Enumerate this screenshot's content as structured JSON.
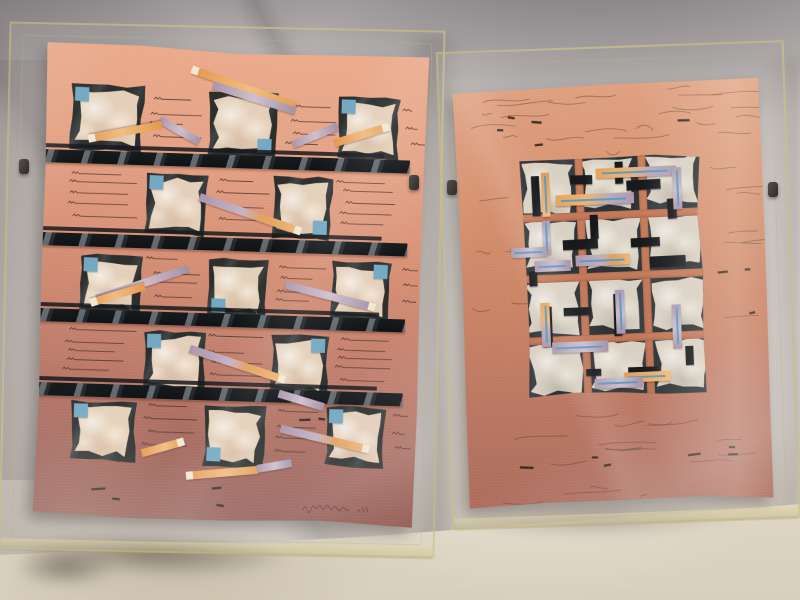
{
  "palette": {
    "fabric": "#d2ccc8",
    "fabric_shadow": "#75737a",
    "floor": "#ddd5c3",
    "paper_left_top": "#ecab8c",
    "paper_left_bottom": "#8f5a53",
    "paper_right_top": "#e0a181",
    "paper_right_bottom": "#ac6c5c",
    "charcoal": "#2e3336",
    "tissue": "#e4d0ba",
    "tissue_right": "#d9d1c3",
    "blue_square": "#74a9c3",
    "blue_line": "#5d9dc2",
    "orange": "#e8a55c",
    "lavender": "#b3a0b5",
    "strip_tip": "#f3e9d3",
    "bar_black": "#14171a",
    "acrylic_edge": "#cbbf81",
    "signature_ink": "#6e352f"
  },
  "frames": {
    "left": {
      "x": 4,
      "y": 26,
      "w": 436,
      "h": 528,
      "rot": 1.2
    },
    "right": {
      "x": 444,
      "y": 46,
      "w": 348,
      "h": 478,
      "rot": -2.0
    },
    "clips": [
      {
        "x": 19,
        "y": 159
      },
      {
        "x": 409,
        "y": 175
      },
      {
        "x": 447,
        "y": 180
      },
      {
        "x": 768,
        "y": 182
      }
    ]
  },
  "floor_shadows": {
    "left": {
      "x": 22,
      "y": 536,
      "w": 350,
      "h": 52,
      "rot": 2
    },
    "right": {
      "x": 444,
      "y": 500,
      "w": 350,
      "h": 44,
      "rot": -1.5
    }
  },
  "left_artwork": {
    "paper": {
      "x": 40,
      "y": 48,
      "w": 382,
      "h": 474,
      "rot": 1.8
    },
    "bar_h": 13,
    "bars": [
      {
        "y": 107
      },
      {
        "y": 190
      },
      {
        "y": 266
      },
      {
        "y": 340
      }
    ],
    "squares": [
      {
        "x": 25,
        "y": 40,
        "w": 74,
        "h": 68,
        "b": "tl"
      },
      {
        "x": 163,
        "y": 42,
        "w": 70,
        "h": 68,
        "b": "br"
      },
      {
        "x": 293,
        "y": 44,
        "w": 62,
        "h": 64,
        "b": "tl"
      },
      {
        "x": 103,
        "y": 126,
        "w": 62,
        "h": 64,
        "b": "tl"
      },
      {
        "x": 230,
        "y": 126,
        "w": 60,
        "h": 64,
        "b": "br"
      },
      {
        "x": 40,
        "y": 210,
        "w": 62,
        "h": 60,
        "b": "tl"
      },
      {
        "x": 168,
        "y": 210,
        "w": 60,
        "h": 60,
        "b": "bl"
      },
      {
        "x": 291,
        "y": 208,
        "w": 60,
        "h": 62,
        "b": "tr"
      },
      {
        "x": 106,
        "y": 284,
        "w": 62,
        "h": 62,
        "b": "tl"
      },
      {
        "x": 233,
        "y": 284,
        "w": 58,
        "h": 62,
        "b": "tr"
      },
      {
        "x": 35,
        "y": 356,
        "w": 66,
        "h": 62,
        "b": "tl"
      },
      {
        "x": 168,
        "y": 356,
        "w": 62,
        "h": 64,
        "b": "bl"
      },
      {
        "x": 290,
        "y": 354,
        "w": 60,
        "h": 62,
        "b": "tl"
      }
    ],
    "strips": [
      {
        "x1": 146,
        "y1": 23,
        "x2": 250,
        "y2": 56,
        "t": "o",
        "tip": "p1"
      },
      {
        "x1": 167,
        "y1": 38,
        "x2": 250,
        "y2": 61,
        "t": "l",
        "tip": ""
      },
      {
        "x1": 115,
        "y1": 74,
        "x2": 155,
        "y2": 95,
        "t": "l",
        "tip": ""
      },
      {
        "x1": 117,
        "y1": 79,
        "x2": 45,
        "y2": 95,
        "t": "o",
        "tip": "p2"
      },
      {
        "x1": 157,
        "y1": 150,
        "x2": 258,
        "y2": 181,
        "t": "lo",
        "tip": "p2"
      },
      {
        "x1": 248,
        "y1": 95,
        "x2": 293,
        "y2": 75,
        "t": "l",
        "tip": ""
      },
      {
        "x1": 290,
        "y1": 92,
        "x2": 343,
        "y2": 74,
        "t": "o",
        "tip": "p2"
      },
      {
        "x1": 57,
        "y1": 255,
        "x2": 147,
        "y2": 222,
        "t": "l",
        "tip": ""
      },
      {
        "x1": 105,
        "y1": 241,
        "x2": 52,
        "y2": 259,
        "t": "o",
        "tip": "p2"
      },
      {
        "x1": 152,
        "y1": 302,
        "x2": 247,
        "y2": 330,
        "t": "lo",
        "tip": "p2"
      },
      {
        "x1": 245,
        "y1": 235,
        "x2": 335,
        "y2": 255,
        "t": "l",
        "tip": "p2"
      },
      {
        "x1": 245,
        "y1": 379,
        "x2": 333,
        "y2": 397,
        "t": "lo",
        "tip": "p2"
      },
      {
        "x1": 107,
        "y1": 408,
        "x2": 148,
        "y2": 395,
        "t": "o",
        "tip": "p2"
      },
      {
        "x1": 153,
        "y1": 429,
        "x2": 223,
        "y2": 421,
        "t": "o",
        "tip": "p1"
      },
      {
        "x1": 223,
        "y1": 420,
        "x2": 257,
        "y2": 413,
        "t": "l",
        "tip": ""
      },
      {
        "x1": 242,
        "y1": 344,
        "x2": 287,
        "y2": 356,
        "t": "l",
        "tip": ""
      }
    ],
    "scribbles": [
      {
        "x": 103,
        "y": 50,
        "w": 54,
        "h": 50,
        "n": 4,
        "t": "line"
      },
      {
        "x": 239,
        "y": 54,
        "w": 46,
        "h": 50,
        "n": 4,
        "t": "line"
      },
      {
        "x": 357,
        "y": 52,
        "w": 16,
        "h": 50,
        "n": 3,
        "t": "line"
      },
      {
        "x": 25,
        "y": 126,
        "w": 70,
        "h": 52,
        "n": 5,
        "t": "line"
      },
      {
        "x": 167,
        "y": 128,
        "w": 56,
        "h": 50,
        "n": 4,
        "t": "line"
      },
      {
        "x": 293,
        "y": 126,
        "w": 62,
        "h": 52,
        "n": 5,
        "t": "line"
      },
      {
        "x": 105,
        "y": 210,
        "w": 56,
        "h": 48,
        "n": 4,
        "t": "line"
      },
      {
        "x": 232,
        "y": 212,
        "w": 52,
        "h": 48,
        "n": 4,
        "t": "line"
      },
      {
        "x": 353,
        "y": 210,
        "w": 18,
        "h": 48,
        "n": 3,
        "t": "line"
      },
      {
        "x": 25,
        "y": 284,
        "w": 74,
        "h": 50,
        "n": 5,
        "t": "line"
      },
      {
        "x": 169,
        "y": 286,
        "w": 58,
        "h": 50,
        "n": 4,
        "t": "line"
      },
      {
        "x": 295,
        "y": 284,
        "w": 60,
        "h": 50,
        "n": 5,
        "t": "line"
      },
      {
        "x": 103,
        "y": 356,
        "w": 58,
        "h": 52,
        "n": 4,
        "t": "line"
      },
      {
        "x": 233,
        "y": 358,
        "w": 50,
        "h": 52,
        "n": 4,
        "t": "line"
      },
      {
        "x": 353,
        "y": 356,
        "w": 18,
        "h": 52,
        "n": 3,
        "t": "line"
      },
      {
        "x": 19,
        "y": 110,
        "w": 30,
        "h": 8,
        "n": 2,
        "t": "dash"
      },
      {
        "x": 19,
        "y": 194,
        "w": 28,
        "h": 8,
        "n": 2,
        "t": "dash"
      },
      {
        "x": 19,
        "y": 270,
        "w": 26,
        "h": 8,
        "n": 2,
        "t": "dash"
      },
      {
        "x": 19,
        "y": 344,
        "w": 28,
        "h": 8,
        "n": 2,
        "t": "dash"
      },
      {
        "x": 47,
        "y": 434,
        "w": 190,
        "h": 26,
        "n": 4,
        "t": "dash"
      },
      {
        "x": 257,
        "y": 360,
        "w": 60,
        "h": 10,
        "n": 2,
        "t": "dash"
      }
    ],
    "signature": {
      "x": 268,
      "y": 450,
      "w": 70,
      "h": 16
    }
  },
  "right_artwork": {
    "paper": {
      "x": 461,
      "y": 84,
      "w": 306,
      "h": 420,
      "rot": -2.4
    },
    "motif": {
      "x": 64,
      "y": 72,
      "w": 180,
      "h": 240,
      "cols": [
        0,
        63,
        126
      ],
      "rows": [
        0,
        61,
        122,
        184
      ],
      "cell_w": 53,
      "cell_h": 53,
      "groove_x": [
        55,
        118
      ],
      "groove_y": [
        55,
        116,
        178
      ],
      "groove_t": 8
    },
    "black_bars": [
      {
        "x": 11,
        "y": 17,
        "w": 8,
        "h": 40
      },
      {
        "x": 50,
        "y": 18,
        "w": 22,
        "h": 9
      },
      {
        "x": 95,
        "y": 6,
        "w": 8,
        "h": 22
      },
      {
        "x": 106,
        "y": 25,
        "w": 34,
        "h": 10
      },
      {
        "x": 146,
        "y": 45,
        "w": 9,
        "h": 20
      },
      {
        "x": 40,
        "y": 82,
        "w": 35,
        "h": 10
      },
      {
        "x": 108,
        "y": 83,
        "w": 29,
        "h": 9
      },
      {
        "x": 126,
        "y": 102,
        "w": 36,
        "h": 11
      },
      {
        "x": 5,
        "y": 112,
        "w": 8,
        "h": 15
      },
      {
        "x": 68,
        "y": 58,
        "w": 8,
        "h": 24
      },
      {
        "x": 16,
        "y": 148,
        "w": 10,
        "h": 40
      },
      {
        "x": 38,
        "y": 150,
        "w": 27,
        "h": 8
      },
      {
        "x": 88,
        "y": 138,
        "w": 8,
        "h": 42
      },
      {
        "x": 58,
        "y": 212,
        "w": 15,
        "h": 7
      },
      {
        "x": 158,
        "y": 193,
        "w": 8,
        "h": 19
      },
      {
        "x": 100,
        "y": 212,
        "w": 30,
        "h": 10
      }
    ],
    "strips": [
      {
        "x": 76,
        "y": 12,
        "w": 80,
        "h": 10,
        "t": "ol",
        "d": "h"
      },
      {
        "x": 152,
        "y": 14,
        "w": 9,
        "h": 42,
        "t": "l",
        "d": "v"
      },
      {
        "x": 21,
        "y": 14,
        "w": 8,
        "h": 44,
        "t": "o",
        "d": "v"
      },
      {
        "x": 35,
        "y": 37,
        "w": 78,
        "h": 11,
        "t": "ol",
        "d": "h"
      },
      {
        "x": 20,
        "y": 62,
        "w": 8,
        "h": 34,
        "t": "l",
        "d": "v"
      },
      {
        "x": 11,
        "y": 102,
        "w": 36,
        "h": 11,
        "t": "l",
        "d": "h"
      },
      {
        "x": 52,
        "y": 98,
        "w": 54,
        "h": 11,
        "t": "lo",
        "d": "h"
      },
      {
        "x": 90,
        "y": 134,
        "w": 9,
        "h": 44,
        "t": "l",
        "d": "v"
      },
      {
        "x": 15,
        "y": 144,
        "w": 9,
        "h": 44,
        "t": "ol",
        "d": "v"
      },
      {
        "x": -12,
        "y": 88,
        "w": 36,
        "h": 10,
        "t": "l",
        "d": "h"
      },
      {
        "x": 25,
        "y": 184,
        "w": 56,
        "h": 11,
        "t": "l",
        "d": "h"
      },
      {
        "x": 146,
        "y": 151,
        "w": 9,
        "h": 44,
        "t": "l",
        "d": "v"
      },
      {
        "x": 96,
        "y": 217,
        "w": 46,
        "h": 10,
        "t": "o",
        "d": "h"
      },
      {
        "x": 66,
        "y": 222,
        "w": 48,
        "h": 10,
        "t": "l",
        "d": "h"
      }
    ],
    "scribbles": [
      {
        "x": 12,
        "y": 6,
        "w": 282,
        "h": 62,
        "n": 22,
        "t": "wisp"
      },
      {
        "x": 6,
        "y": 80,
        "w": 54,
        "h": 150,
        "n": 6,
        "t": "wisp"
      },
      {
        "x": 252,
        "y": 86,
        "w": 48,
        "h": 160,
        "n": 7,
        "t": "wisp"
      },
      {
        "x": 12,
        "y": 326,
        "w": 288,
        "h": 92,
        "n": 17,
        "t": "wisp"
      },
      {
        "x": 30,
        "y": 26,
        "w": 250,
        "h": 40,
        "n": 5,
        "t": "dash"
      },
      {
        "x": 40,
        "y": 338,
        "w": 230,
        "h": 60,
        "n": 6,
        "t": "dash"
      },
      {
        "x": 252,
        "y": 186,
        "w": 40,
        "h": 60,
        "n": 3,
        "t": "dash"
      }
    ]
  }
}
